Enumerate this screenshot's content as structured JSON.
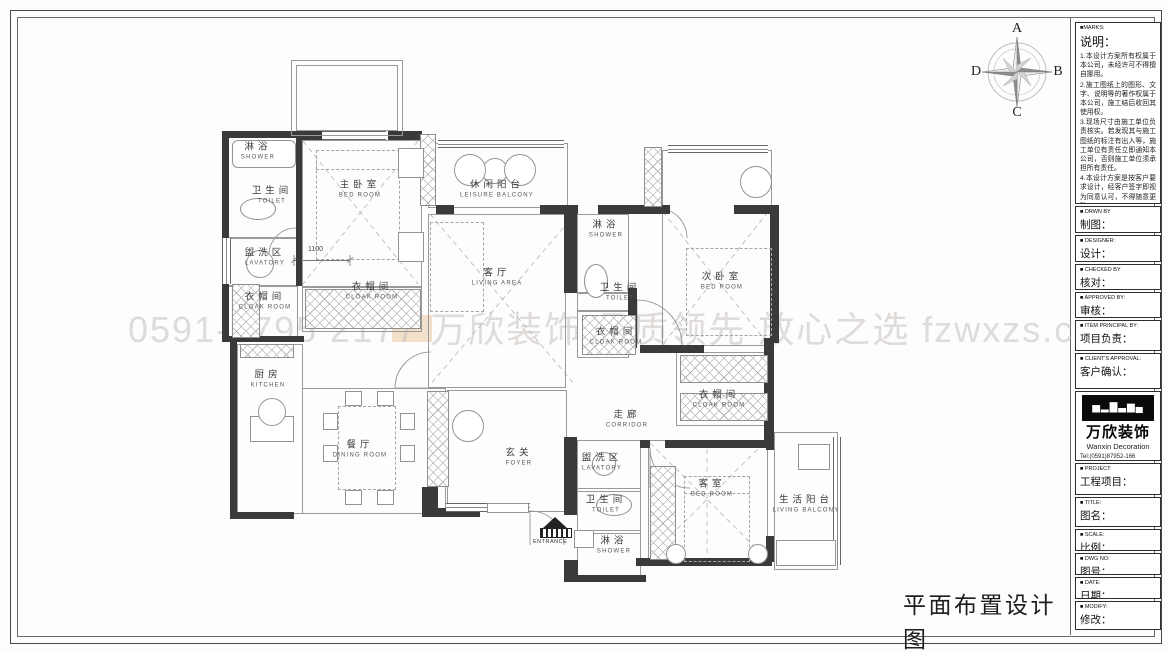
{
  "drawing": {
    "title": "平面布置设计图",
    "watermark": "0591-8795 2177  万欣装饰  品质领先  放心之选  fzwxzs.com",
    "dimension_label": "1100",
    "entrance_label": "ENTRANCE",
    "compass": {
      "top": "A",
      "right": "B",
      "bottom": "C",
      "left": "D"
    }
  },
  "rooms": [
    {
      "cn": "淋浴",
      "en": "SHOWER",
      "x": 258,
      "y": 152
    },
    {
      "cn": "卫生间",
      "en": "TOILET",
      "x": 272,
      "y": 196
    },
    {
      "cn": "盥洗区",
      "en": "LAVATORY",
      "x": 265,
      "y": 258
    },
    {
      "cn": "衣帽间",
      "en": "CLOAK ROOM",
      "x": 265,
      "y": 302
    },
    {
      "cn": "主卧室",
      "en": "BED ROOM",
      "x": 360,
      "y": 190
    },
    {
      "cn": "衣帽间",
      "en": "CLOAK ROOM",
      "x": 372,
      "y": 292
    },
    {
      "cn": "休闲阳台",
      "en": "LEISURE BALCONY",
      "x": 497,
      "y": 190
    },
    {
      "cn": "客厅",
      "en": "LIVING AREA",
      "x": 497,
      "y": 278
    },
    {
      "cn": "淋浴",
      "en": "SHOWER",
      "x": 606,
      "y": 230
    },
    {
      "cn": "卫生间",
      "en": "TOILET",
      "x": 620,
      "y": 293
    },
    {
      "cn": "衣帽间",
      "en": "CLOAK ROOM",
      "x": 616,
      "y": 337
    },
    {
      "cn": "次卧室",
      "en": "BED ROOM",
      "x": 722,
      "y": 282
    },
    {
      "cn": "厨房",
      "en": "KITCHEN",
      "x": 268,
      "y": 380
    },
    {
      "cn": "餐厅",
      "en": "DINING ROOM",
      "x": 360,
      "y": 450
    },
    {
      "cn": "玄关",
      "en": "FOYER",
      "x": 519,
      "y": 458
    },
    {
      "cn": "走廊",
      "en": "CORRIDOR",
      "x": 627,
      "y": 420
    },
    {
      "cn": "衣帽间",
      "en": "CLOAK ROOM",
      "x": 719,
      "y": 400
    },
    {
      "cn": "盥洗区",
      "en": "LAVATORY",
      "x": 602,
      "y": 463
    },
    {
      "cn": "卫生间",
      "en": "TOILET",
      "x": 606,
      "y": 505
    },
    {
      "cn": "淋浴",
      "en": "SHOWER",
      "x": 614,
      "y": 546
    },
    {
      "cn": "客室",
      "en": "BED ROOM",
      "x": 712,
      "y": 489
    },
    {
      "cn": "生活阳台",
      "en": "LIVING BALCONY",
      "x": 806,
      "y": 505
    }
  ],
  "title_block": {
    "marks": {
      "tag": "■MARKS:",
      "heading": "说明：",
      "notes": [
        "1.本设计方案所有权属于本公司，未经许可不得擅自挪用。",
        "2.施工图纸上的图形、文字、说明等的著作权属于本公司，施工结后收回其使用权。",
        "3.现场尺寸由施工单位负责核实。若发现其与施工图纸的标注有出入等，施工单位有责任立即通知本公司，否则施工单位须承担所有责任。",
        "4.本设计方案是按客户要求设计，经客户签字即视为同意认可，不得随意更改。"
      ]
    },
    "rows": [
      {
        "tag": "■ DRWN BY",
        "label": "制图："
      },
      {
        "tag": "■ DESIGNER:",
        "label": "设计："
      },
      {
        "tag": "■ CHECKED BY",
        "label": "核对："
      },
      {
        "tag": "■ APPROVED BY:",
        "label": "审核："
      },
      {
        "tag": "■ ITEM PRINCIPAL BY:",
        "label": "项目负责："
      },
      {
        "tag": "■ CLIENT'S APPROVAL:",
        "label": "客户确认："
      }
    ],
    "company": {
      "logo_art": "▅▂▇▃▆▄",
      "name_cn": "万欣装饰",
      "name_en": "Wanxin Decoration",
      "tel1": "Tel:(0591)87952-166",
      "tel2": "(0591)87952-177",
      "fax": "Fax:(0591)87952-199",
      "web": "Web:WWW.fzwxzs.com"
    },
    "rows2": [
      {
        "tag": "■ PROJECT:",
        "label": "工程项目："
      },
      {
        "tag": "■ TITLE:",
        "label": "图名："
      },
      {
        "tag": "■ SCALE:",
        "label": "比例："
      },
      {
        "tag": "■ DWG NO:",
        "label": "图号："
      },
      {
        "tag": "■ DATE:",
        "label": "日期："
      },
      {
        "tag": "■ MODIFY:",
        "label": "修改："
      }
    ]
  }
}
